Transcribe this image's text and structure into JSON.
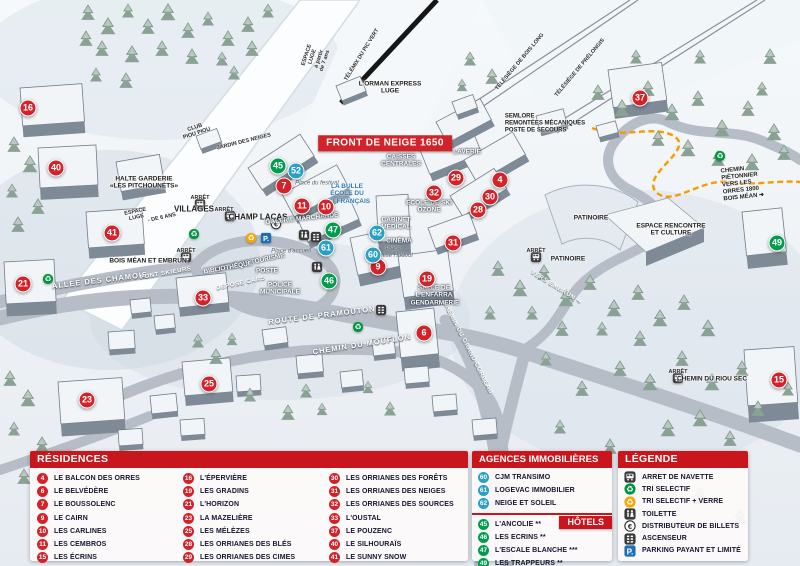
{
  "colors": {
    "red": "#c9161d",
    "marker_red": "#d2232a",
    "green": "#009e4c",
    "blue": "#2aa0c4"
  },
  "map": {
    "markers": [
      {
        "n": "16",
        "t": "r",
        "x": 28,
        "y": 108
      },
      {
        "n": "40",
        "t": "r",
        "x": 56,
        "y": 168
      },
      {
        "n": "41",
        "t": "r",
        "x": 112,
        "y": 233
      },
      {
        "n": "21",
        "t": "r",
        "x": 23,
        "y": 284
      },
      {
        "n": "33",
        "t": "r",
        "x": 203,
        "y": 298
      },
      {
        "n": "23",
        "t": "r",
        "x": 87,
        "y": 400
      },
      {
        "n": "25",
        "t": "r",
        "x": 209,
        "y": 384
      },
      {
        "n": "7",
        "t": "r",
        "x": 284,
        "y": 186
      },
      {
        "n": "11",
        "t": "r",
        "x": 302,
        "y": 206
      },
      {
        "n": "10",
        "t": "r",
        "x": 326,
        "y": 207
      },
      {
        "n": "9",
        "t": "r",
        "x": 378,
        "y": 267
      },
      {
        "n": "19",
        "t": "r",
        "x": 427,
        "y": 279
      },
      {
        "n": "6",
        "t": "r",
        "x": 424,
        "y": 333
      },
      {
        "n": "29",
        "t": "r",
        "x": 456,
        "y": 178
      },
      {
        "n": "32",
        "t": "r",
        "x": 434,
        "y": 193
      },
      {
        "n": "4",
        "t": "r",
        "x": 500,
        "y": 180
      },
      {
        "n": "30",
        "t": "r",
        "x": 490,
        "y": 197
      },
      {
        "n": "28",
        "t": "r",
        "x": 478,
        "y": 210
      },
      {
        "n": "31",
        "t": "r",
        "x": 453,
        "y": 243
      },
      {
        "n": "37",
        "t": "r",
        "x": 640,
        "y": 98
      },
      {
        "n": "15",
        "t": "r",
        "x": 779,
        "y": 380
      },
      {
        "n": "45",
        "t": "h",
        "x": 278,
        "y": 166
      },
      {
        "n": "47",
        "t": "h",
        "x": 333,
        "y": 230
      },
      {
        "n": "46",
        "t": "h",
        "x": 329,
        "y": 281
      },
      {
        "n": "49",
        "t": "h",
        "x": 777,
        "y": 243
      },
      {
        "n": "52",
        "t": "a",
        "x": 296,
        "y": 171
      },
      {
        "n": "61",
        "t": "a",
        "x": 326,
        "y": 248
      },
      {
        "n": "62",
        "t": "a",
        "x": 377,
        "y": 233
      },
      {
        "n": "60",
        "t": "a",
        "x": 373,
        "y": 255
      }
    ],
    "labels": [
      {
        "t": "FRONT DE NEIGE 1650",
        "x": 385,
        "y": 143,
        "r": 0,
        "c": "banner"
      },
      {
        "t": "L'ORMAN EXPRESS\nLUGE",
        "x": 390,
        "y": 88,
        "r": 0,
        "c": "dark"
      },
      {
        "t": "TÉLÉMIX DU PIC VERT",
        "x": 362,
        "y": 55,
        "r": -58,
        "c": "micro"
      },
      {
        "t": "TÉLÉSIÈGE DE BOIS LONG",
        "x": 520,
        "y": 62,
        "r": -50,
        "c": "micro"
      },
      {
        "t": "TÉLÉSIÈGE DE PRÉLONGIS",
        "x": 580,
        "y": 68,
        "r": -50,
        "c": "micro"
      },
      {
        "t": "SEMLORE\nREMONTÉES MÉCANIQUES\nPOSTE DE SECOURS",
        "x": 545,
        "y": 124,
        "r": 0,
        "c": "darksm"
      },
      {
        "t": "ESPACE\nLUGE\nà partir\nde 7 ans",
        "x": 316,
        "y": 58,
        "r": -72,
        "c": "micro"
      },
      {
        "t": "CLUB\nPIOU PIOU",
        "x": 196,
        "y": 131,
        "r": -18,
        "c": "micro"
      },
      {
        "t": "JARDIN DES NEIGES",
        "x": 244,
        "y": 142,
        "r": -14,
        "c": "micro"
      },
      {
        "t": "HALTE GARDERIE\n«LES PITCHOUNETS»",
        "x": 144,
        "y": 183,
        "r": 0,
        "c": "dark"
      },
      {
        "t": "ARRÊT",
        "x": 200,
        "y": 198,
        "r": 0,
        "c": "micro"
      },
      {
        "t": "VILLAGES",
        "x": 194,
        "y": 209,
        "r": 0,
        "c": "darkbig"
      },
      {
        "t": "ARRÊT",
        "x": 224,
        "y": 210,
        "r": 0,
        "c": "micro"
      },
      {
        "t": "CHAMP LACAS",
        "x": 258,
        "y": 217,
        "r": 0,
        "c": "darkbig"
      },
      {
        "t": "ESPACE\nLUGE",
        "x": 136,
        "y": 215,
        "r": -12,
        "c": "micro"
      },
      {
        "t": "- DE 6 ANS",
        "x": 162,
        "y": 218,
        "r": -12,
        "c": "micro"
      },
      {
        "t": "ALLÉE DES CHAMOIS",
        "x": 100,
        "y": 281,
        "r": -7,
        "c": "road"
      },
      {
        "t": "ARRÊT",
        "x": 186,
        "y": 251,
        "r": 0,
        "c": "micro"
      },
      {
        "t": "BOIS MÉAN ET EMBRUN",
        "x": 148,
        "y": 261,
        "r": 0,
        "c": "dark"
      },
      {
        "t": "PONT SKIEURS",
        "x": 166,
        "y": 274,
        "r": -10,
        "c": "roadsm"
      },
      {
        "t": "Place du festival",
        "x": 317,
        "y": 184,
        "r": 0,
        "c": "italic"
      },
      {
        "t": "LA BULLE\nÉCOLE DU\nSKI FRANÇAIS",
        "x": 347,
        "y": 194,
        "r": 0,
        "c": "blue"
      },
      {
        "t": "GALERIE MARCHANDE",
        "x": 302,
        "y": 219,
        "r": -6,
        "c": "white"
      },
      {
        "t": "CAISSES\nCENTRALES",
        "x": 401,
        "y": 161,
        "r": 0,
        "c": "white"
      },
      {
        "t": "LAVERIE",
        "x": 467,
        "y": 152,
        "r": 0,
        "c": "white"
      },
      {
        "t": "ÉCOLE DE SKI\nOZONE",
        "x": 429,
        "y": 207,
        "r": 0,
        "c": "white"
      },
      {
        "t": "CABINET\nMÉDICAL",
        "x": 396,
        "y": 224,
        "r": 0,
        "c": "white"
      },
      {
        "t": "CINÉMA",
        "x": 399,
        "y": 241,
        "r": 0,
        "c": "white"
      },
      {
        "t": "Place\nDenise Hodoul",
        "x": 393,
        "y": 253,
        "r": 0,
        "c": "italic"
      },
      {
        "t": "OFFICE DE TOURISME",
        "x": 250,
        "y": 263,
        "r": -12,
        "c": "white"
      },
      {
        "t": "Place d'accueil",
        "x": 291,
        "y": 252,
        "r": 0,
        "c": "italic"
      },
      {
        "t": "BIBLIOTHÈQUE",
        "x": 228,
        "y": 268,
        "r": -10,
        "c": "white"
      },
      {
        "t": "POSTE",
        "x": 267,
        "y": 271,
        "r": 0,
        "c": "white"
      },
      {
        "t": "DÉPOSE CARS",
        "x": 241,
        "y": 284,
        "r": -12,
        "c": "roadsm"
      },
      {
        "t": "POLICE\nMUNICIPALE",
        "x": 280,
        "y": 289,
        "r": 0,
        "c": "white"
      },
      {
        "t": "ROUTE DE PRAMOUTON",
        "x": 322,
        "y": 316,
        "r": -7,
        "c": "road"
      },
      {
        "t": "CHEMIN DU MOUFLON",
        "x": 362,
        "y": 345,
        "r": -9,
        "c": "road"
      },
      {
        "t": "CHEMIN DU GRAND CORBEAU",
        "x": 467,
        "y": 348,
        "r": 63,
        "c": "roadsm"
      },
      {
        "t": "SALLE DE\nL'ENFARRA",
        "x": 434,
        "y": 292,
        "r": 0,
        "c": "white"
      },
      {
        "t": "GENDARMERIE",
        "x": 435,
        "y": 303,
        "r": 0,
        "c": "white"
      },
      {
        "t": "PATINOIRE",
        "x": 591,
        "y": 218,
        "r": 0,
        "c": "dark"
      },
      {
        "t": "ARRÊT",
        "x": 536,
        "y": 251,
        "r": 0,
        "c": "micro"
      },
      {
        "t": "PATINOIRE",
        "x": 568,
        "y": 259,
        "r": 0,
        "c": "dark"
      },
      {
        "t": "ESPACE RENCONTRE\nET CULTURE",
        "x": 671,
        "y": 230,
        "r": 0,
        "c": "dark"
      },
      {
        "t": "VERS EMBRUN ➔",
        "x": 556,
        "y": 288,
        "r": 32,
        "c": "roadsm"
      },
      {
        "t": "CHEMIN PIÉTONNIER\nVERS LES ORRES 1800\nBOIS MÉAN ➔",
        "x": 748,
        "y": 183,
        "r": -6,
        "c": "darksm"
      },
      {
        "t": "ARRÊT",
        "x": 678,
        "y": 372,
        "r": 0,
        "c": "micro"
      },
      {
        "t": "CHEMIN DU RIOU SEC",
        "x": 712,
        "y": 379,
        "r": 0,
        "c": "dark"
      }
    ],
    "icons": [
      {
        "k": "bus",
        "x": 200,
        "y": 204
      },
      {
        "k": "bus",
        "x": 230,
        "y": 216
      },
      {
        "k": "bus",
        "x": 186,
        "y": 257
      },
      {
        "k": "bus",
        "x": 536,
        "y": 257
      },
      {
        "k": "bus",
        "x": 678,
        "y": 378
      },
      {
        "k": "recycle-green",
        "x": 48,
        "y": 279
      },
      {
        "k": "recycle-green",
        "x": 194,
        "y": 234
      },
      {
        "k": "recycle-green",
        "x": 358,
        "y": 327
      },
      {
        "k": "recycle-green",
        "x": 720,
        "y": 156
      },
      {
        "k": "recycle-yellow",
        "x": 251,
        "y": 238
      },
      {
        "k": "parking",
        "x": 266,
        "y": 238
      },
      {
        "k": "euro",
        "x": 276,
        "y": 224
      },
      {
        "k": "toilet",
        "x": 304,
        "y": 235
      },
      {
        "k": "elevator",
        "x": 316,
        "y": 237
      },
      {
        "k": "toilet",
        "x": 317,
        "y": 267
      },
      {
        "k": "elevator",
        "x": 381,
        "y": 310
      }
    ]
  },
  "panels": {
    "residences": {
      "title": "RÉSIDENCES",
      "columns": [
        [
          {
            "n": "4",
            "label": "LE BALCON DES ORRES"
          },
          {
            "n": "6",
            "label": "LE BELVÉDÈRE"
          },
          {
            "n": "7",
            "label": "LE BOUSSOLENC"
          },
          {
            "n": "9",
            "label": "LE CAIRN"
          },
          {
            "n": "10",
            "label": "LES CARLINES"
          },
          {
            "n": "11",
            "label": "LES CEMBROS"
          },
          {
            "n": "15",
            "label": "LES ÉCRINS"
          }
        ],
        [
          {
            "n": "16",
            "label": "L'ÉPERVIÈRE"
          },
          {
            "n": "19",
            "label": "LES GRADINS"
          },
          {
            "n": "21",
            "label": "L'HORIZON"
          },
          {
            "n": "23",
            "label": "LA MAZELIÈRE"
          },
          {
            "n": "25",
            "label": "LES MÉLÈZES"
          },
          {
            "n": "28",
            "label": "LES ORRIANES DES BLÉS"
          },
          {
            "n": "29",
            "label": "LES ORRIANES DES CIMES"
          }
        ],
        [
          {
            "n": "30",
            "label": "LES ORRIANES DES FORÊTS"
          },
          {
            "n": "31",
            "label": "LES ORRIANES DES NEIGES"
          },
          {
            "n": "32",
            "label": "LES ORRIANES DES SOURCES"
          },
          {
            "n": "33",
            "label": "L'OUSTAL"
          },
          {
            "n": "37",
            "label": "LE POUZENC"
          },
          {
            "n": "40",
            "label": "LE SILHOURAÏS"
          },
          {
            "n": "41",
            "label": "LE SUNNY SNOW"
          }
        ]
      ]
    },
    "agences": {
      "title": "AGENCES IMMOBILIÈRES",
      "items": [
        {
          "n": "60",
          "label": "CJM TRANSIMO"
        },
        {
          "n": "61",
          "label": "LOGEVAC IMMOBILIER"
        },
        {
          "n": "62",
          "label": "NEIGE ET SOLEIL"
        }
      ]
    },
    "hotels": {
      "title": "HÔTELS",
      "items": [
        {
          "n": "45",
          "label": "L'ANCOLIE **"
        },
        {
          "n": "46",
          "label": "LES ECRINS **"
        },
        {
          "n": "47",
          "label": "L'ESCALE BLANCHE ***"
        },
        {
          "n": "49",
          "label": "LES TRAPPEURS **"
        }
      ]
    },
    "legende": {
      "title": "LÉGENDE",
      "items": [
        {
          "icon": "bus",
          "label": "ARRET DE NAVETTE"
        },
        {
          "icon": "recycle-green",
          "label": "TRI SELECTIF"
        },
        {
          "icon": "recycle-yellow",
          "label": "TRI SELECTIF + VERRE"
        },
        {
          "icon": "toilet",
          "label": "TOILETTE"
        },
        {
          "icon": "euro",
          "label": "DISTRIBUTEUR DE BILLETS"
        },
        {
          "icon": "elevator",
          "label": "ASCENSEUR"
        },
        {
          "icon": "parking",
          "label": "PARKING PAYANT ET LIMITÉ"
        }
      ]
    }
  }
}
